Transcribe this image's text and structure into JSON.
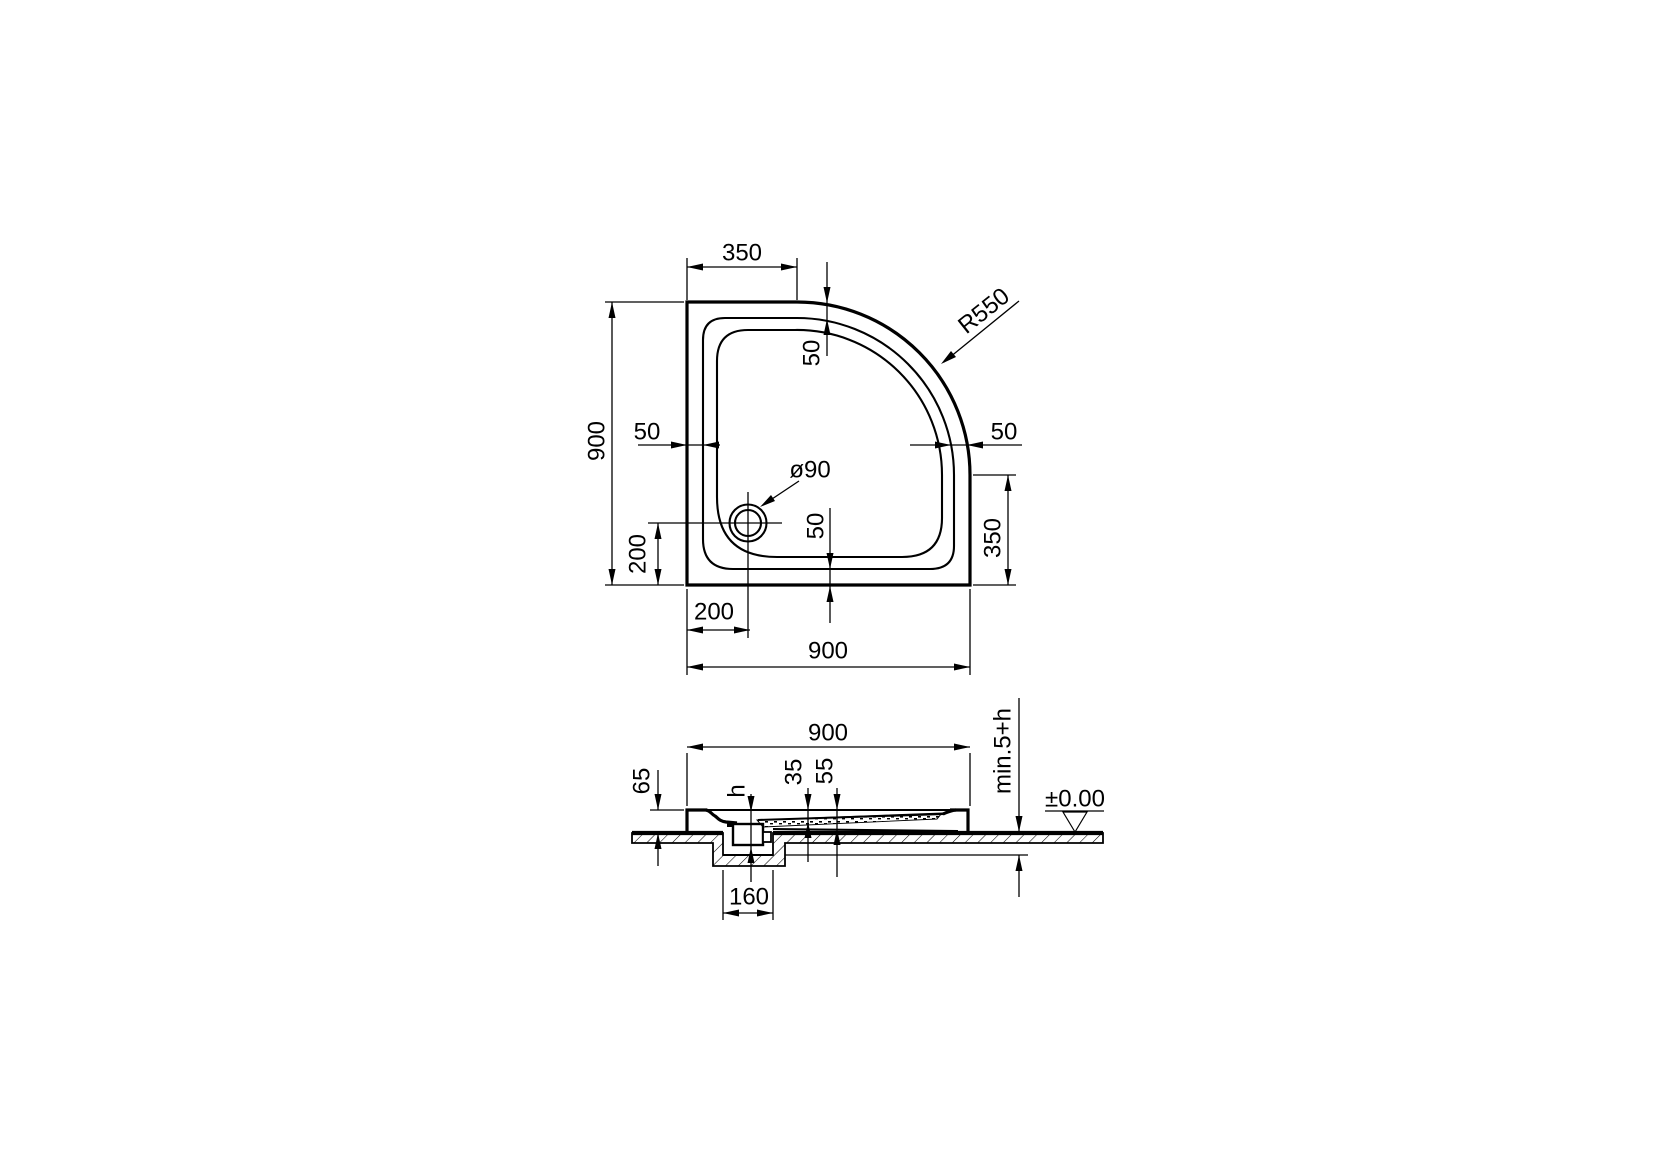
{
  "drawing": {
    "description": "Quadrant shower tray technical drawing, plan view and installation section",
    "plan_view": {
      "dim_top_straight": "350",
      "dim_corner_radius": "R550",
      "dim_rim_top": "50",
      "dim_height": "900",
      "dim_rim_left": "50",
      "dim_rim_right": "50",
      "dim_drain_diameter": "ø90",
      "dim_right_straight": "350",
      "dim_rim_bottom": "50",
      "dim_drain_from_bottom": "200",
      "dim_drain_from_left": "200",
      "dim_width": "900"
    },
    "section_view": {
      "dim_width": "900",
      "dim_tray_height": "65",
      "dim_trap_height": "h",
      "dim_basin_depth": "35",
      "dim_shell_depth": "55",
      "dim_recess_depth": "min.5+h",
      "dim_floor_level": "±0.00",
      "dim_recess_width": "160"
    }
  }
}
